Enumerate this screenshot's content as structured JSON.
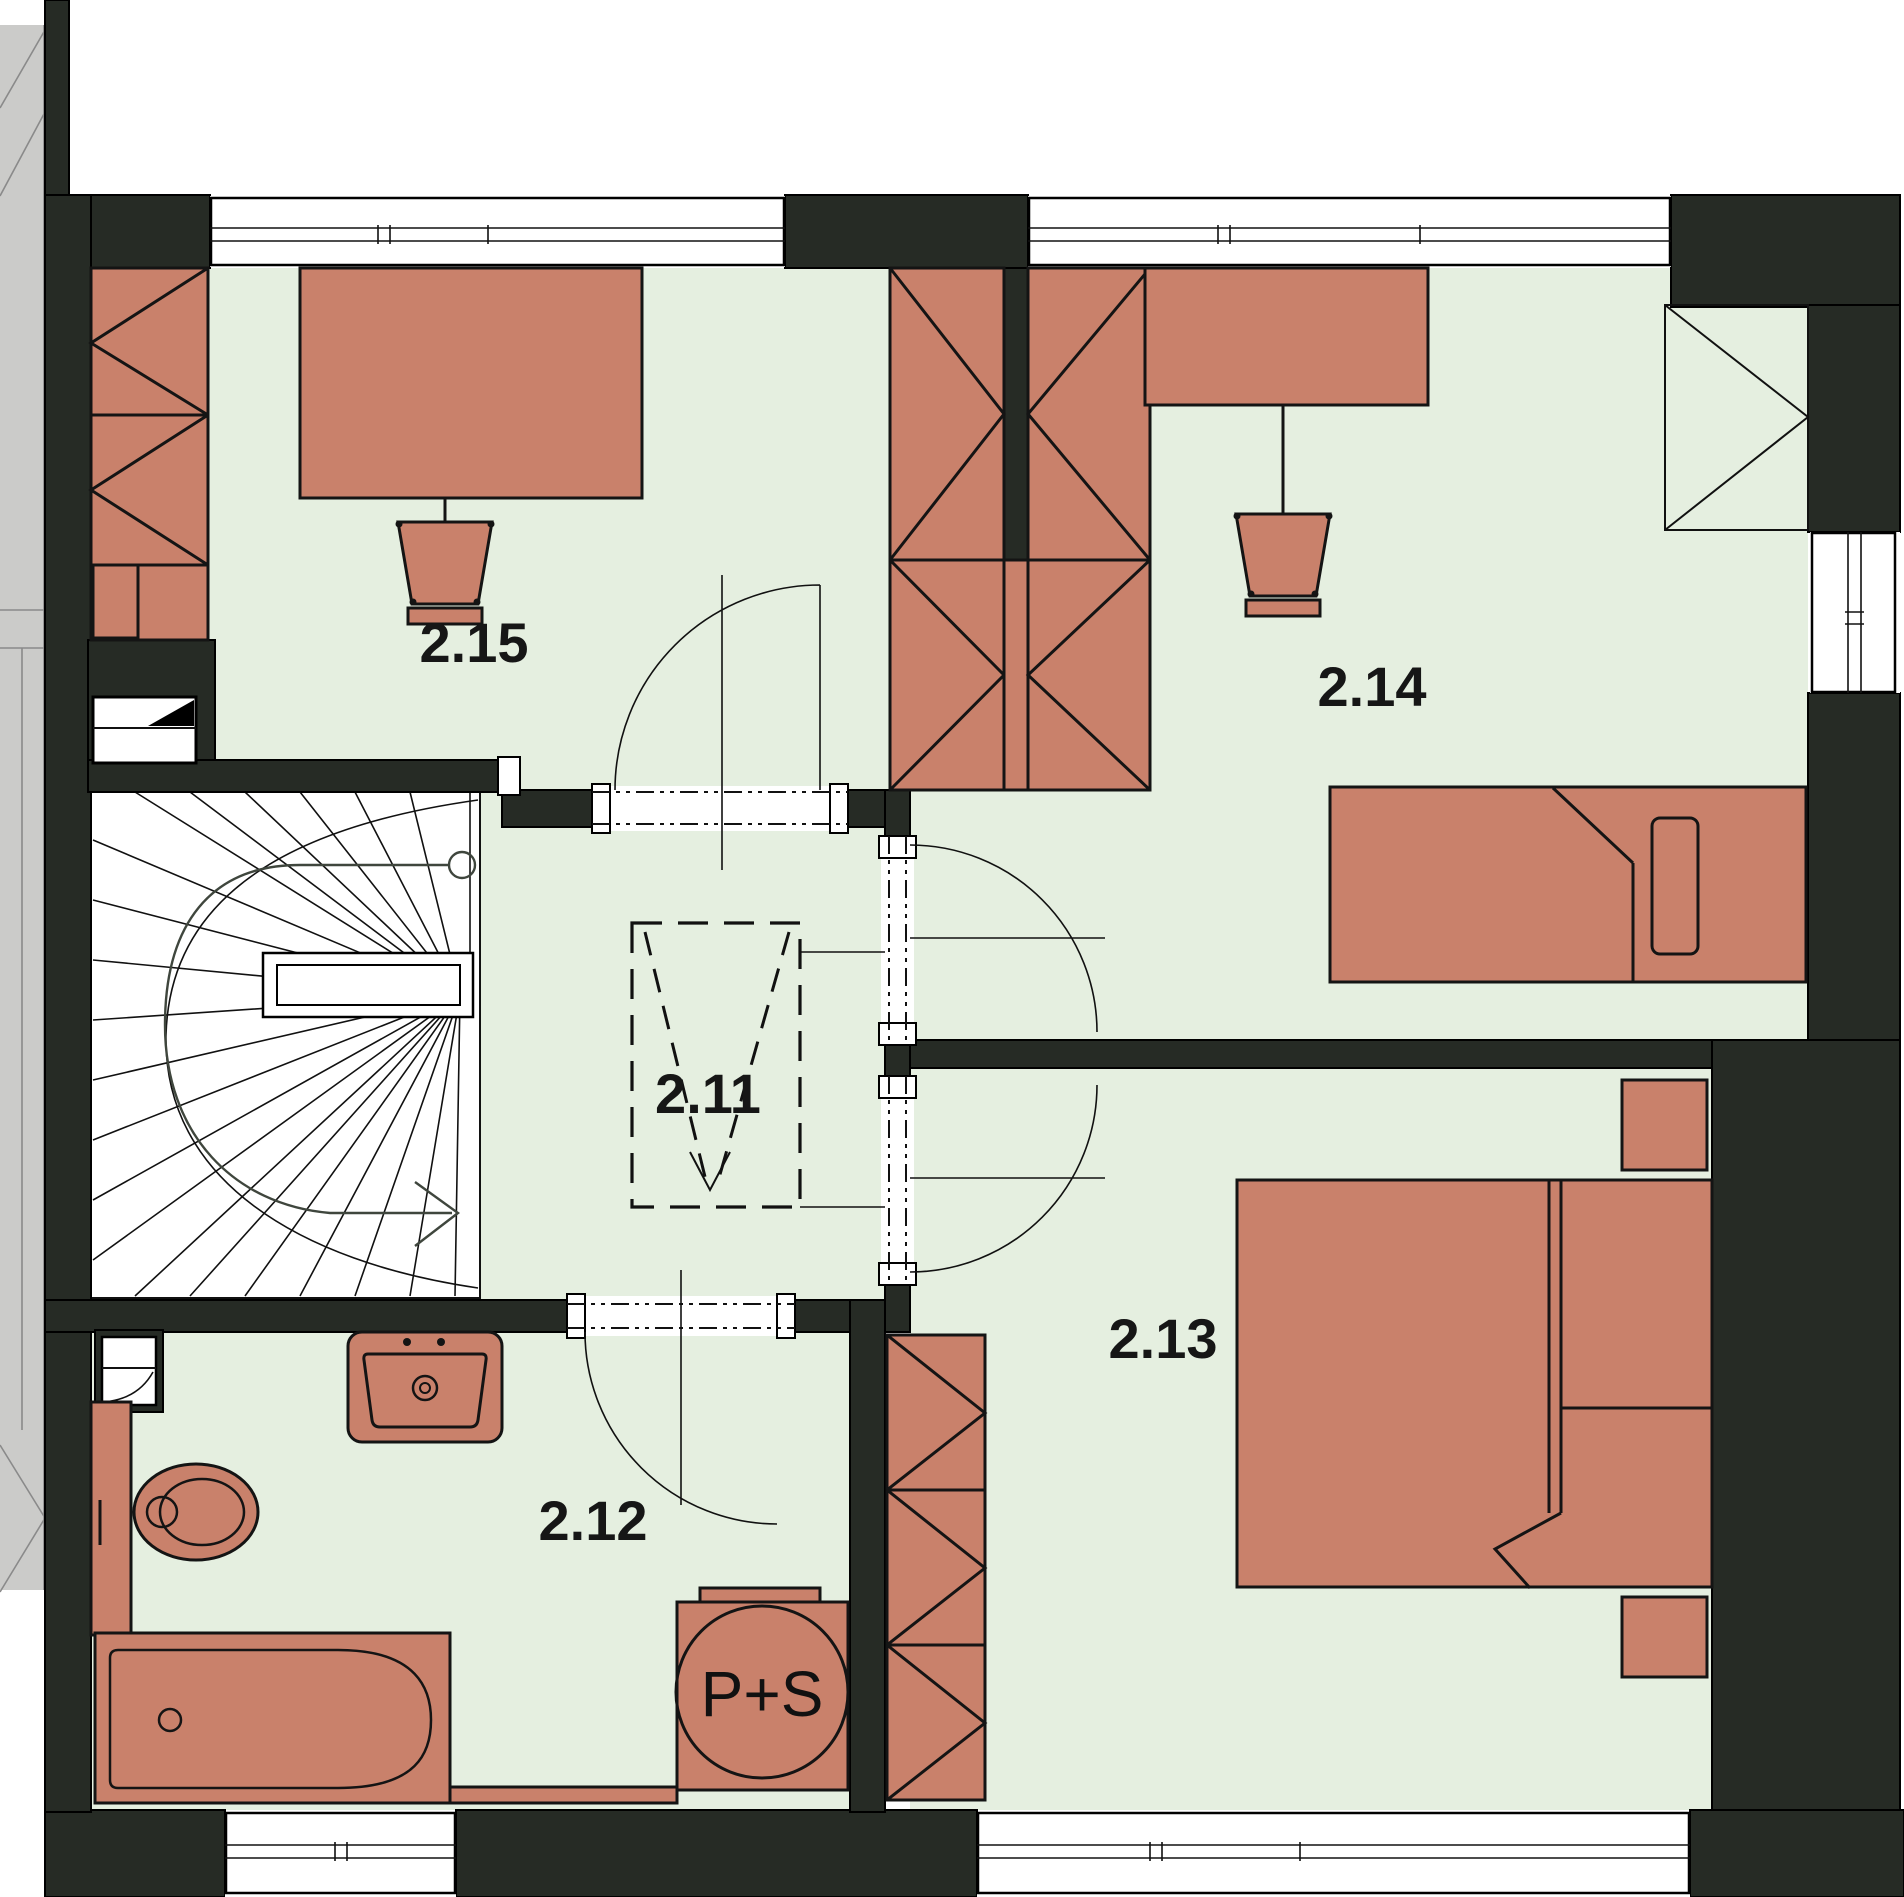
{
  "floorplan": {
    "labels": {
      "hall": "2.11",
      "bathroom": "2.12",
      "bedroom_master": "2.13",
      "bedroom_right": "2.14",
      "bedroom_left": "2.15",
      "washer_dryer": "P+S"
    },
    "colors": {
      "wall": "#262b25",
      "floor": "#e5efe0",
      "furn": "#c9816b",
      "neighbor": "#cbcbc9"
    }
  }
}
